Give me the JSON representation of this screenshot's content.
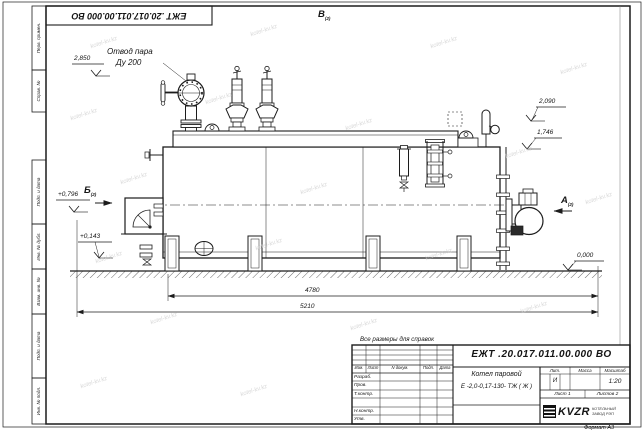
{
  "sheet": {
    "designation": "ЕЖТ .20.017.011.00.000  ВО",
    "top_designation": "ЕЖТ .20.017.011.00.000  ВО",
    "format_note": "Формат А3",
    "reference_note": "Все размеры для справок"
  },
  "frame": {
    "left_top_labels": [
      "Перв. примен.",
      "Справ. №"
    ],
    "left_bottom_labels": [
      "Подп. и дата",
      "Инв. № дубл.",
      "Взам. инв. №",
      "Подп. и дата",
      "Инв. № подл."
    ]
  },
  "title_block": {
    "header_cols": [
      "Изм.",
      "Лист",
      "N докум.",
      "Подп.",
      "Дата"
    ],
    "sig_rows": [
      "Разраб.",
      "Пров.",
      "Т.контр.",
      "Н.контр.",
      "Утв."
    ],
    "product_name_line1": "Котел паровой",
    "product_name_line2": "Е -2,0-0,17-130- ТЖ ( Ж )",
    "lit_label": "Лит.",
    "mass_label": "Масса",
    "scale_label": "Масштаб",
    "lit_value": "И",
    "scale_value": "1:20",
    "sheet_label": "Лист",
    "sheet_value": "1",
    "sheets_label": "Листов",
    "sheets_value": "2",
    "company": "KVZR",
    "company_sub1": "КОТЕЛЬНЫЙ",
    "company_sub2": "ЗАВОД РЭП"
  },
  "annotations": {
    "steam_outlet_line1": "Отвод пара",
    "steam_outlet_line2": "Ду 200",
    "elev_2850": "2,850",
    "elev_2090": "2,090",
    "elev_1746": "1,746",
    "elev_0796": "+0,796",
    "elev_0143": "+0,143",
    "elev_0000": "0,000",
    "dim_4780": "4780",
    "dim_5210": "5210",
    "view_a": "А",
    "view_b": "Б",
    "view_v": "В",
    "view_sheet_ref": "(2)"
  },
  "watermark": {
    "text": "kotel-kv.kz"
  }
}
